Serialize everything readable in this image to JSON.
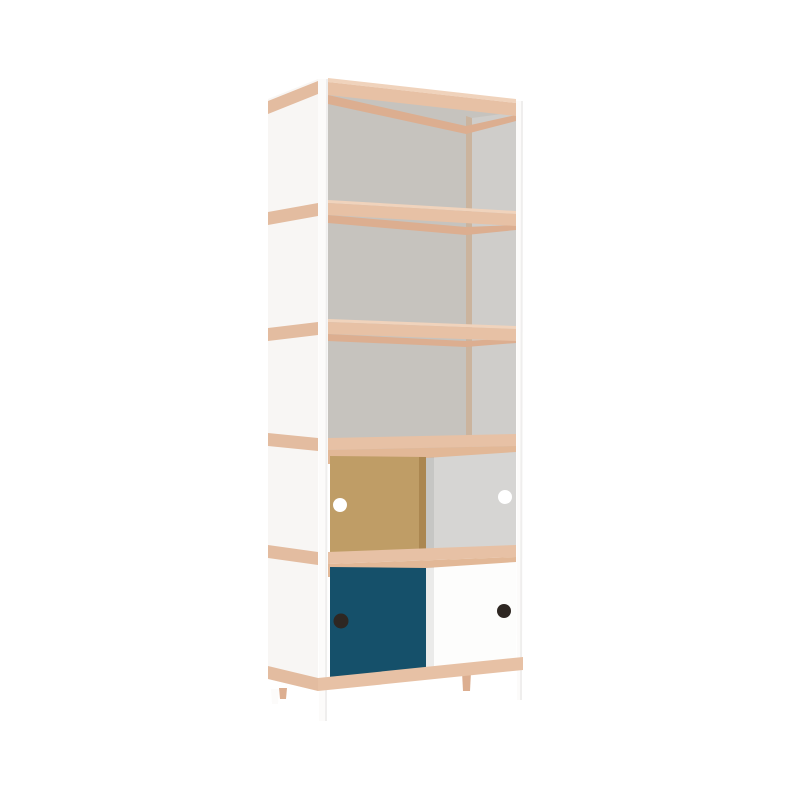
{
  "meta": {
    "description": "Tall shelving unit with white frame and legs, wooden shelf edge bands, three open shelf bays with grey back panel, one bay with plywood and grey sliding doors, one bay with petrol-blue and white sliding doors, round finger holes in each door",
    "background": "#ffffff"
  },
  "colors": {
    "background": "#ffffff",
    "frame_white": "#fcfbfa",
    "side_panel_white": "#f8f6f4",
    "wood_face": "#e7c1a5",
    "wood_side": "#e3bca0",
    "wood_top": "#f0d3bc",
    "wood_under": "#dcae90",
    "wood_track": "#e2b897",
    "back_panel": "#c6c3be",
    "side_wall": "#cfcdca",
    "corner_strip": "#cbb49e",
    "mdf_door": "#bf9d66",
    "mdf_door_edge": "#ab8751",
    "grey_door": "#d6d5d3",
    "teal_door": "#15506a",
    "white_door": "#fdfdfc",
    "hole_white": "#ffffff",
    "hole_dark": "#2e2722",
    "soft_shadow": "rgba(0,0,0,0.07)",
    "edge_shade": "rgba(0,0,0,0.05)"
  }
}
